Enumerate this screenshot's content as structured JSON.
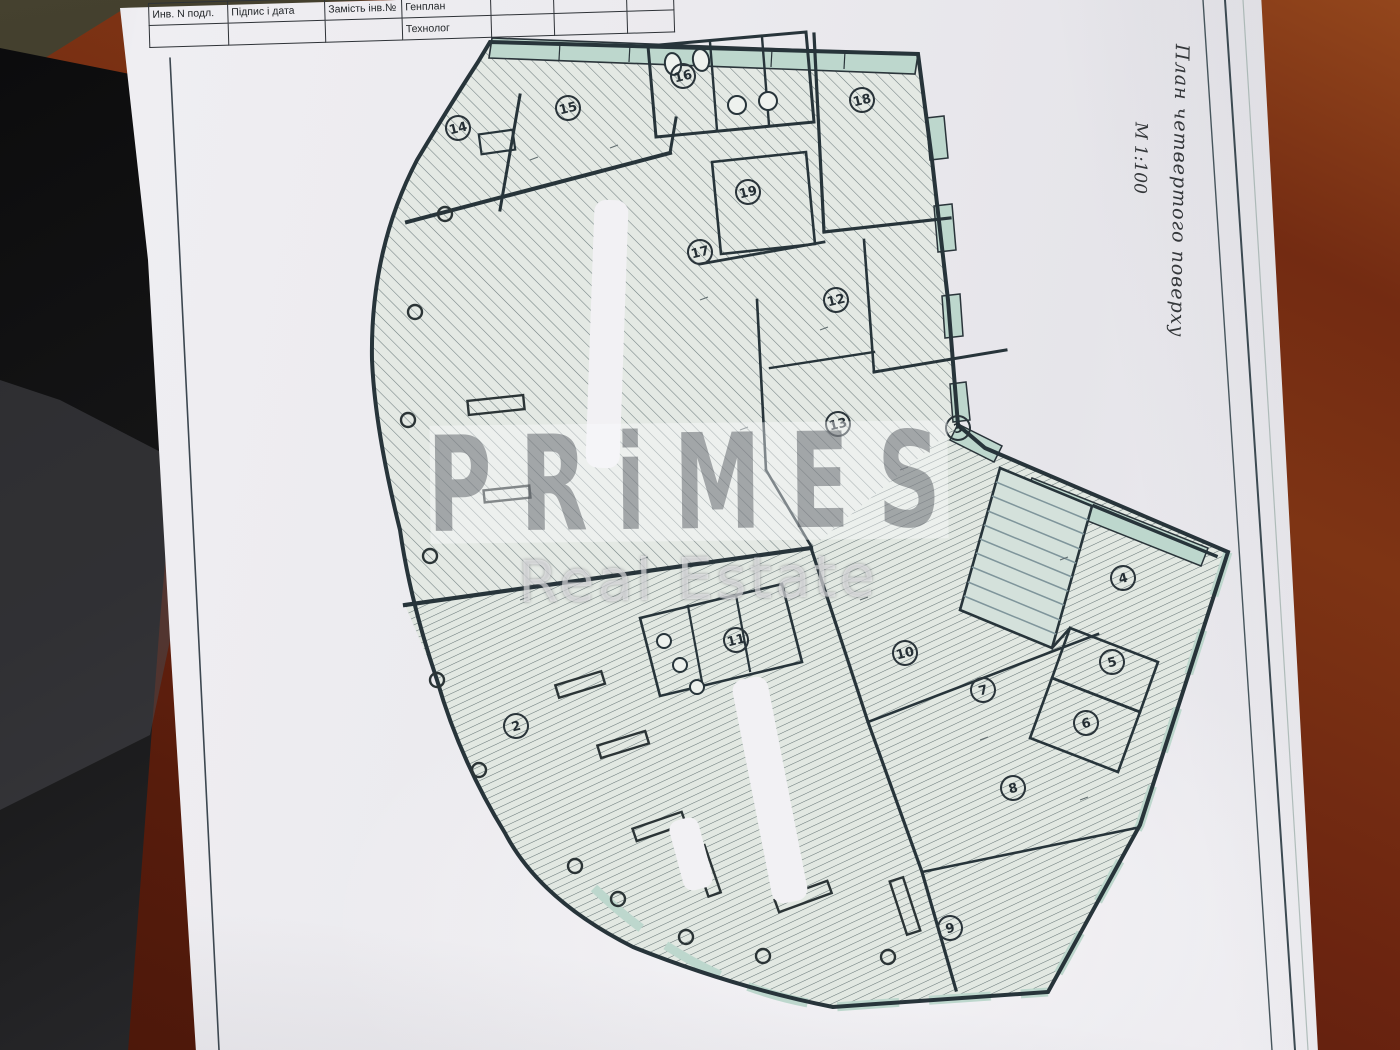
{
  "title_block": {
    "cells": [
      "Инв. N подл.",
      "Підпис і дата",
      "Замість інв.№"
    ],
    "dept_top": "Генплан",
    "dept_bottom": "Технолог"
  },
  "side_notes": {
    "plan_title": "План четвертого поверху",
    "scale": "М 1:100"
  },
  "watermark": {
    "brand": "PRiMES",
    "subtitle": "Real Estate"
  },
  "plan": {
    "rooms": [
      {
        "n": "14",
        "x": 458,
        "y": 128
      },
      {
        "n": "15",
        "x": 568,
        "y": 108
      },
      {
        "n": "16",
        "x": 683,
        "y": 76
      },
      {
        "n": "18",
        "x": 862,
        "y": 100
      },
      {
        "n": "19",
        "x": 748,
        "y": 192
      },
      {
        "n": "17",
        "x": 700,
        "y": 252
      },
      {
        "n": "12",
        "x": 836,
        "y": 300
      },
      {
        "n": "13",
        "x": 838,
        "y": 424
      },
      {
        "n": "3",
        "x": 958,
        "y": 428
      },
      {
        "n": "11",
        "x": 736,
        "y": 640
      },
      {
        "n": "10",
        "x": 905,
        "y": 653
      },
      {
        "n": "7",
        "x": 983,
        "y": 690
      },
      {
        "n": "4",
        "x": 1123,
        "y": 578
      },
      {
        "n": "5",
        "x": 1112,
        "y": 662
      },
      {
        "n": "6",
        "x": 1086,
        "y": 723
      },
      {
        "n": "8",
        "x": 1013,
        "y": 788
      },
      {
        "n": "2",
        "x": 516,
        "y": 726
      },
      {
        "n": "9",
        "x": 950,
        "y": 928
      }
    ],
    "colors": {
      "wall": "#27343a",
      "window": "#bdd7cd",
      "hatch_upper": "#5d6d70",
      "hatch_lower": "#57686a",
      "floor": "#e4e9e4"
    }
  }
}
